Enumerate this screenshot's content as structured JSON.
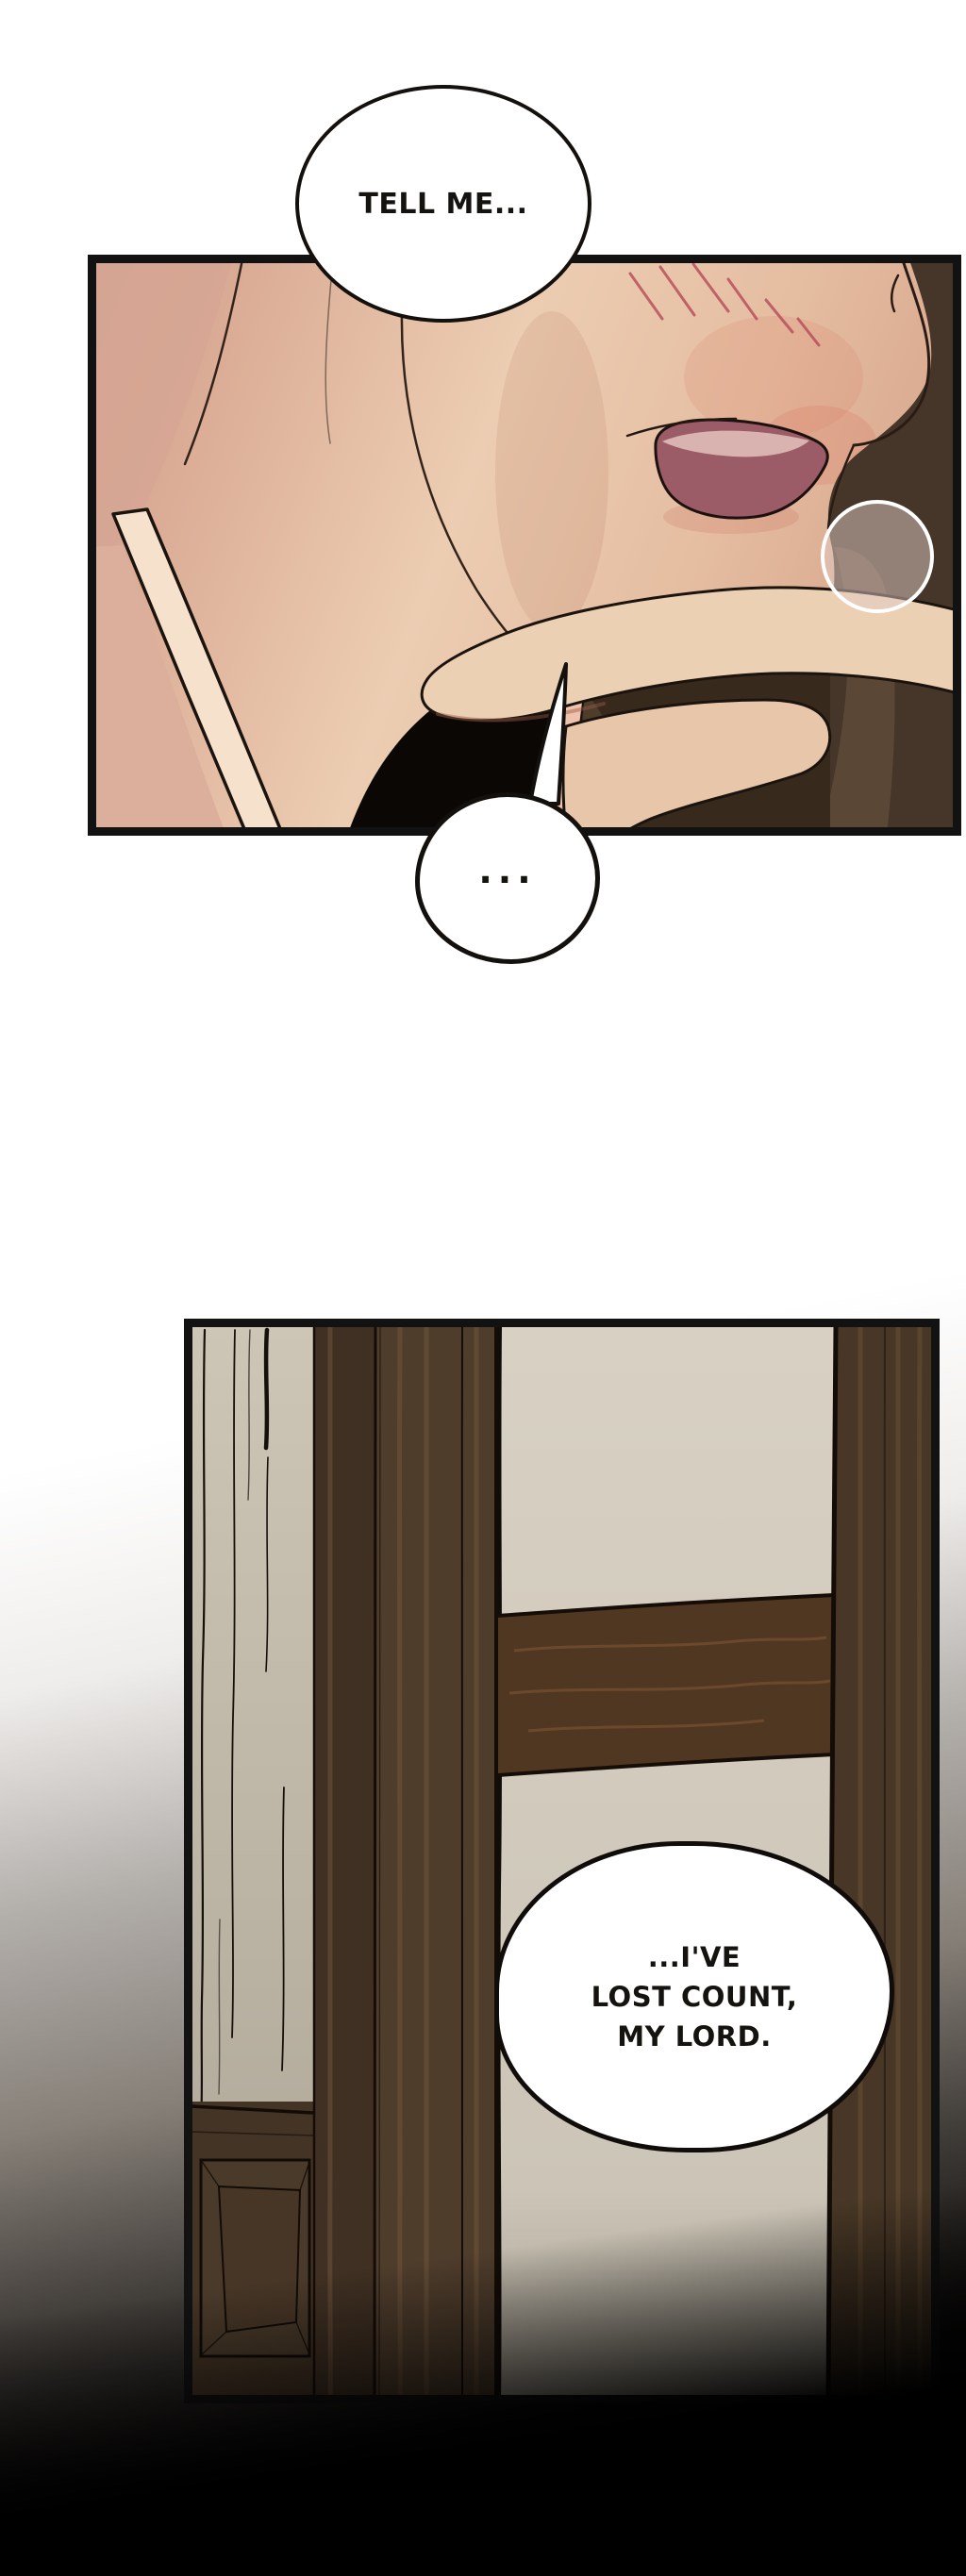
{
  "page_type": "comic-page",
  "dialogue": {
    "bubble1": {
      "text": "TELL ME..."
    },
    "bubble2": {
      "text": "..."
    },
    "bubble3": {
      "lines": [
        "...I'VE",
        "LOST COUNT,",
        "MY LORD."
      ]
    }
  },
  "colors": {
    "page_top": "#ffffff",
    "page_bottom": "#000000",
    "panel_border": "#121212",
    "skin_light": "#eccdb2",
    "skin_shadow": "#d3a291",
    "strap_cream": "#f6e2cc",
    "mouth_tongue": "#9b5b67",
    "mouth_inner_light": "#d9b3b0",
    "blush": "#b9515c",
    "hair_dark": "#453629",
    "hair_olive": "#5c4937",
    "shadow_black": "#0a0705",
    "wall_beige": "#cdc5b5",
    "paper_cream": "#d6cec0",
    "wood_dark": "#4f3d2c",
    "wood_crossbar": "#503722",
    "wood_right": "#483726",
    "bubble_fill": "#ffffff",
    "bubble_outline": "#14100d"
  }
}
